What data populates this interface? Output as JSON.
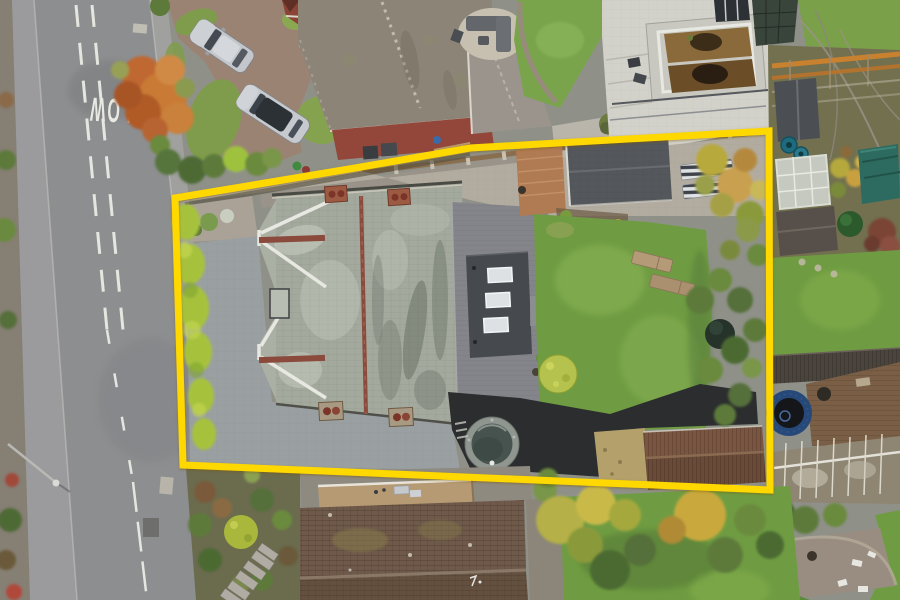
{
  "photo": {
    "kind": "aerial-drone-photograph",
    "subject": "detached house plot with highlighted boundary"
  },
  "boundary": {
    "color": "#ffd800",
    "stroke_width": 7,
    "points_attr": "175,198 355,168 470,148 769,131 770,490 183,465"
  },
  "road": {
    "marking": "SLOW",
    "marking_color": "#e9e9e3"
  },
  "palette": {
    "boundary": "#ffd800",
    "road": "#8d8e90",
    "sidewalk": "#9b9b9d",
    "paving": "#9aa0a2",
    "patio": "#b2aca0",
    "slate-roof": "#a3aa9d",
    "ridge-red": "#8a4a3c",
    "ext-roof": "#46494d",
    "deck": "#84858a",
    "lawn": "#6f9c42",
    "lawn-light": "#8db457",
    "hedge": "#a6c23c",
    "tarmac": "#2b2d2e",
    "hot-tub-rim": "#8f958f",
    "hot-tub-water": "#47534e",
    "shed-brown": "#6a4a38",
    "neighbour-roof": "#6e594a",
    "flat-roof": "#b59a74",
    "trampoline": "#27497a",
    "pergola": "#c8812e",
    "brick-drive": "#9b8374",
    "grass-verge": "#7f9c4c"
  }
}
